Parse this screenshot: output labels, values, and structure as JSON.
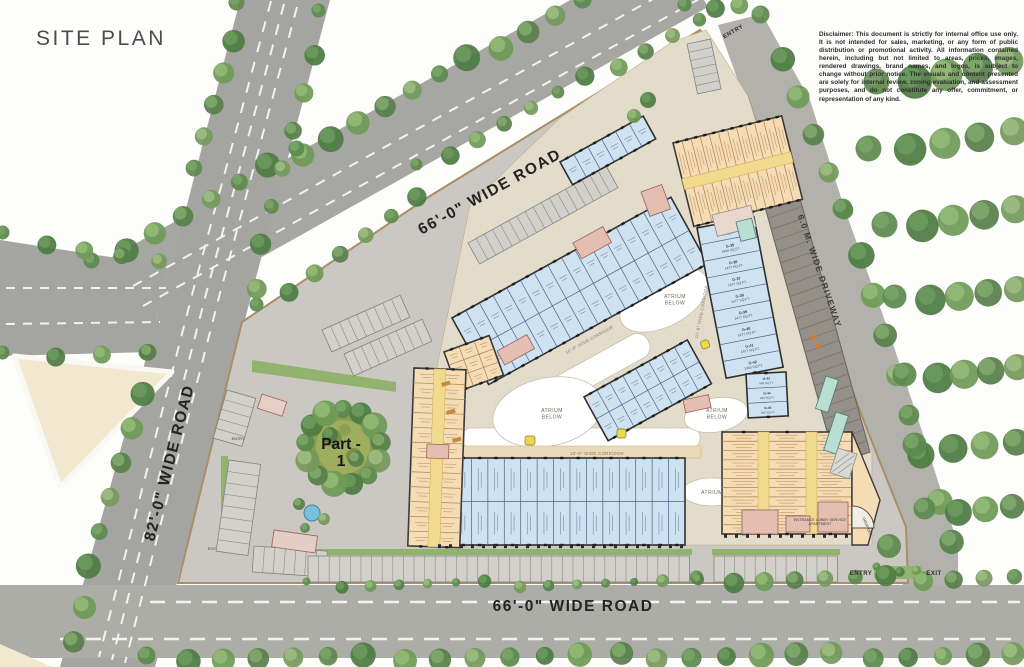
{
  "title": "SITE PLAN",
  "disclaimer": "Disclaimer: This document is strictly for internal office use only. It is not intended for sales, marketing, or any form of public distribution or promotional activity. All information contained herein, including but not limited to areas, prices, images, rendered drawings, brand names, and logos, is subject to change without prior notice. The visuals and content presented are solely for internal review, zoning evaluation, and assessment purposes, and do not constitute any offer, commitment, or representation of any kind.",
  "roads": {
    "top": "66'-0\" WIDE ROAD",
    "left": "82'-0\" WIDE ROAD",
    "bottom": "66'-0\" WIDE ROAD",
    "driveway": "6.0 M. WIDE DRIVEWAY"
  },
  "site": {
    "part_line1": "Part -",
    "part_line2": "1",
    "atrium_line1": "ATRIUM",
    "atrium_line2": "BELOW",
    "atrium": "ATRIUM",
    "corridor": "10'-8\" WIDE CORRIDOR",
    "lobby_line1": "ENTRANCE LOBBY SERVICE",
    "lobby_line2": "APARTMENT",
    "drop_off": "DROP OFF",
    "entry": "ENTRY",
    "exit": "EXIT"
  },
  "colors": {
    "road": "#a6a6a2",
    "pavement": "#cbc7c2",
    "podium": "#e3dccb",
    "shop_blue": "#cfe2f2",
    "shop_tan": "#f6dcb4",
    "core_pink": "#e5beb2",
    "corridor_yellow": "#f0da8e",
    "tree_green": "#5d8a4e"
  },
  "units": [
    {
      "id": "G-34",
      "area": "876 SQ.FT."
    },
    {
      "id": "G-35",
      "area": "1469 SQ.FT."
    },
    {
      "id": "G-36",
      "area": "1477 SQ.FT."
    },
    {
      "id": "G-37",
      "area": "1477 SQ.FT."
    },
    {
      "id": "G-38",
      "area": "1477 SQ.FT."
    },
    {
      "id": "G-39",
      "area": "1477 SQ.FT."
    },
    {
      "id": "G-40",
      "area": "1477 SQ.FT."
    },
    {
      "id": "G-41",
      "area": "1477 SQ.FT."
    },
    {
      "id": "G-42",
      "area": "1365 SQ.FT."
    }
  ],
  "units_west": [
    {
      "id": "G-43",
      "area": "848 SQ.FT."
    },
    {
      "id": "G-44",
      "area": "839 SQ.FT."
    },
    {
      "id": "G-45",
      "area": "845 SQ.FT."
    }
  ]
}
